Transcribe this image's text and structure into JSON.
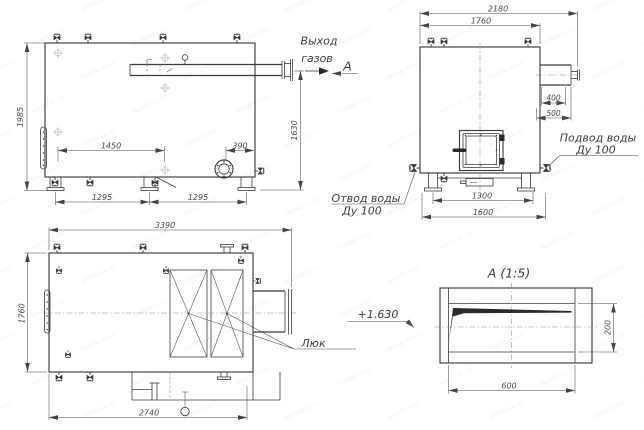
{
  "drawing": {
    "watermark": "teplab-kv.kz",
    "front_view": {
      "dim_height": "1985",
      "dim_valve_span": "1450",
      "dim_burner_offset": "390",
      "dim_base_left": "1295",
      "dim_base_right": "1295",
      "dim_outlet_height": "1630",
      "label_gas_outlet_1": "Выход",
      "label_gas_outlet_2": "газов",
      "view_letter": "А"
    },
    "side_view": {
      "dim_total_width": "2180",
      "dim_body_width": "1760",
      "dim_duct_1": "400",
      "dim_duct_2": "500",
      "dim_base_inner": "1300",
      "dim_base_outer": "1600",
      "label_water_inlet_1": "Подвод воды",
      "label_water_inlet_2": "Ду 100",
      "label_water_outlet_1": "Отвод воды",
      "label_water_outlet_2": "Ду 100"
    },
    "plan_view": {
      "dim_total_length": "3390",
      "dim_width": "1760",
      "dim_base_length": "2740",
      "label_hatch": "Люк"
    },
    "detail_view": {
      "title": "А (1:5)",
      "dim_width": "600",
      "dim_height": "200",
      "elevation_mark": "+1.630"
    }
  }
}
